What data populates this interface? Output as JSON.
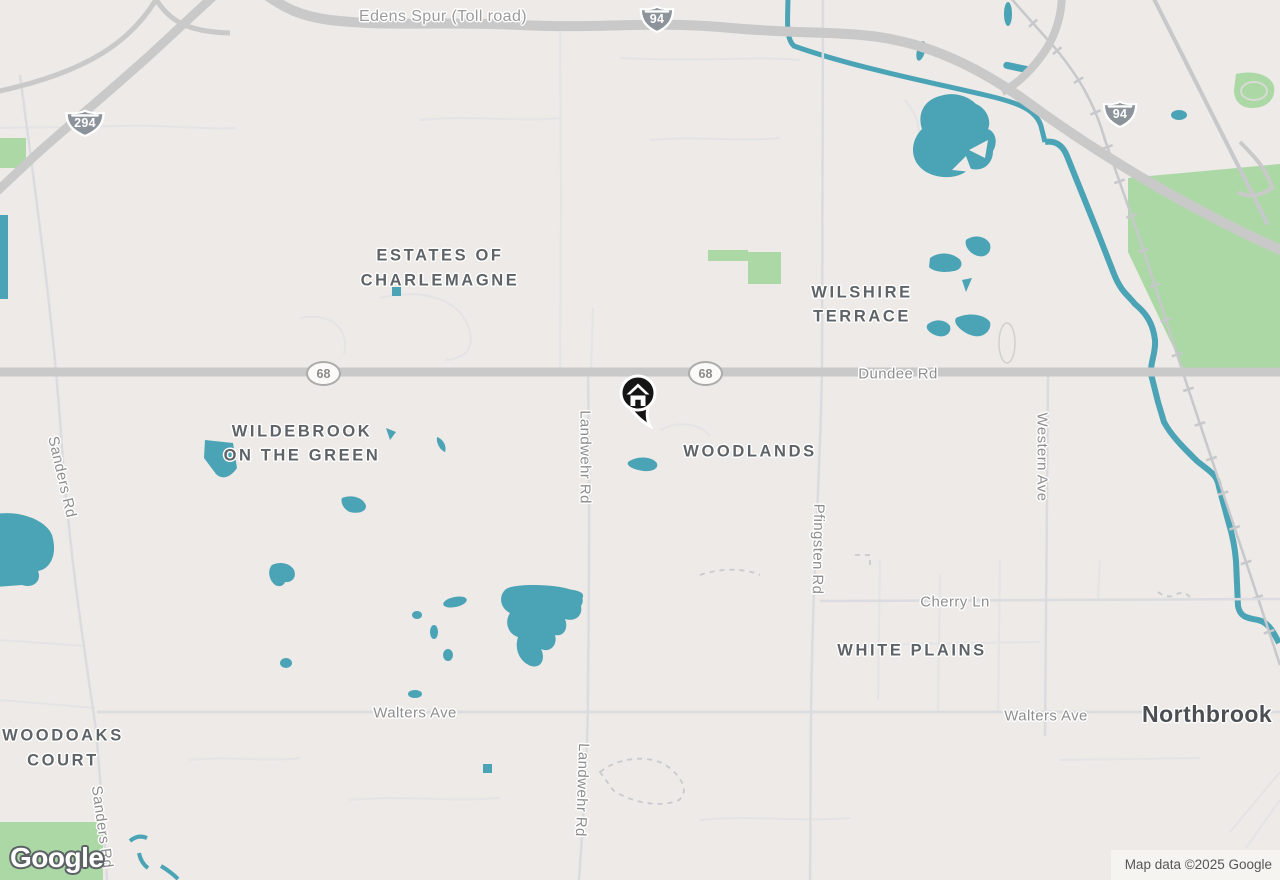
{
  "map": {
    "neighborhoods": {
      "estates": {
        "line1": "ESTATES OF",
        "line2": "CHARLEMAGNE"
      },
      "wilshire": {
        "line1": "WILSHIRE",
        "line2": "TERRACE"
      },
      "wildebrook": {
        "line1": "WILDEBROOK",
        "line2": "ON THE GREEN"
      },
      "woodlands": "WOODLANDS",
      "white_plains": "WHITE PLAINS",
      "woodoaks": {
        "line1": "WOODOAKS",
        "line2": "COURT"
      }
    },
    "places": {
      "northbrook": "Northbrook"
    },
    "roads": {
      "edens_spur": "Edens Spur (Toll road)",
      "dundee": "Dundee Rd",
      "cherry": "Cherry Ln",
      "walters": "Walters Ave",
      "sanders": "Sanders Rd",
      "landwehr": "Landwehr Rd",
      "pfingsten": "Pfingsten Rd",
      "western": "Western Ave"
    },
    "shields": {
      "i294": "294",
      "i94": "94",
      "il68": "68"
    },
    "marker": {
      "type": "home-location-pin"
    },
    "branding": {
      "logo": "Google"
    },
    "attribution": {
      "text": "Map data ©2025 Google"
    },
    "colors": {
      "background": "#EDEAE7",
      "water": "#4BA3B6",
      "park": "#ABD8A4",
      "major_road": "#C9C9C9",
      "area_label": "#5E6367",
      "road_label": "#8E8E8E"
    }
  }
}
